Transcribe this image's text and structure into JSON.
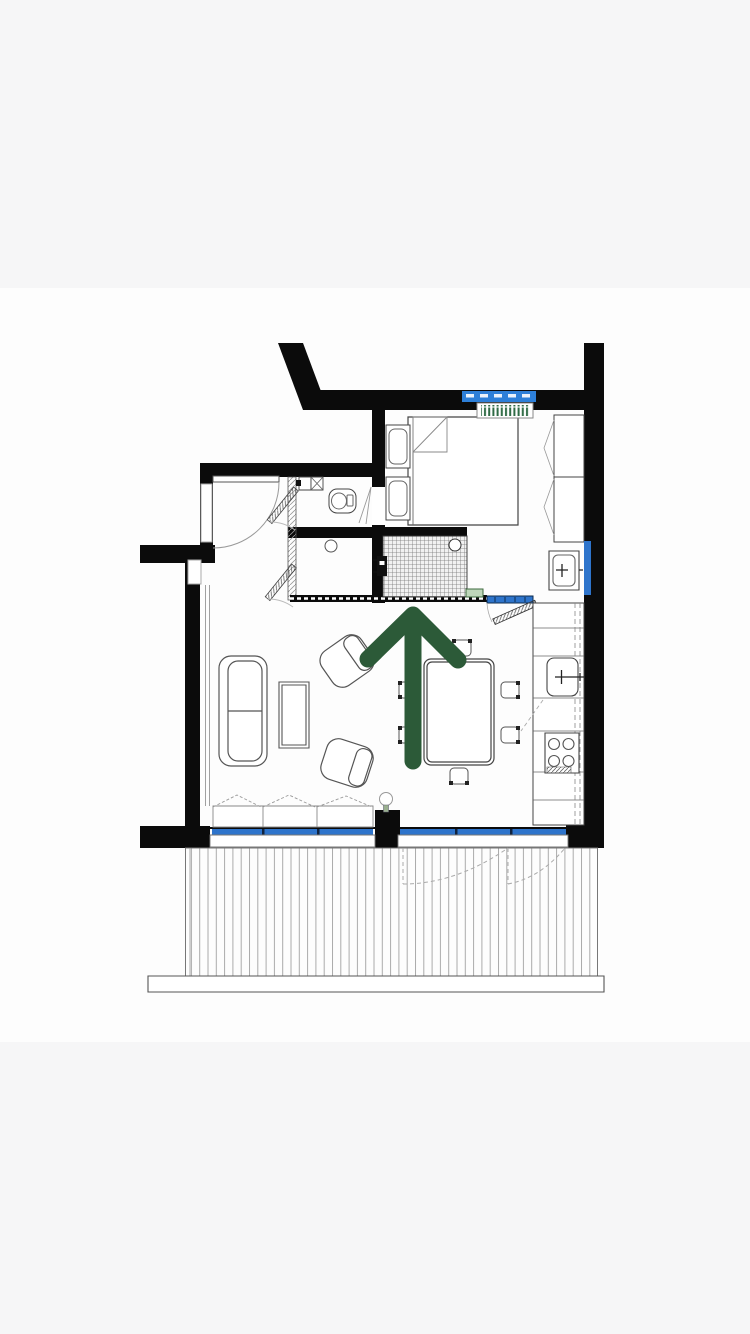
{
  "colors": {
    "background": "#f6f6f7",
    "sheet": "#fdfdfd",
    "wall": "#0b0b0b",
    "line": "#4a4a4a",
    "line_soft": "#9a9a9a",
    "window_blue": "#2e74cb",
    "dim_bar_blue": "#2d7fd8",
    "arrow_green": "#2c5a38",
    "radiator_green": "#2f6b45",
    "mat_green": "#bed7ba",
    "lamp_green": "#9ab08f",
    "deck_line": "#aaaaaa"
  },
  "annotation": {
    "name": "direction-arrow",
    "direction": "up"
  },
  "floorplan": {
    "symbols": [
      "entry-door",
      "wc-door",
      "shower-door",
      "corner-sink",
      "toilet",
      "floor-drain",
      "shower-tiles",
      "shower-valve",
      "shower-mat",
      "bed",
      "nightstand",
      "wardrobe",
      "washbasin",
      "radiator",
      "window",
      "dimension-bar",
      "interior-window",
      "bedroom-door",
      "sofa",
      "coffee-table",
      "armchair",
      "dining-table",
      "dining-chair",
      "floor-lamp",
      "kitchen-counter",
      "kitchen-sink",
      "cooktop",
      "window-sill",
      "balcony-deck",
      "balcony-door",
      "balcony-rim"
    ]
  }
}
